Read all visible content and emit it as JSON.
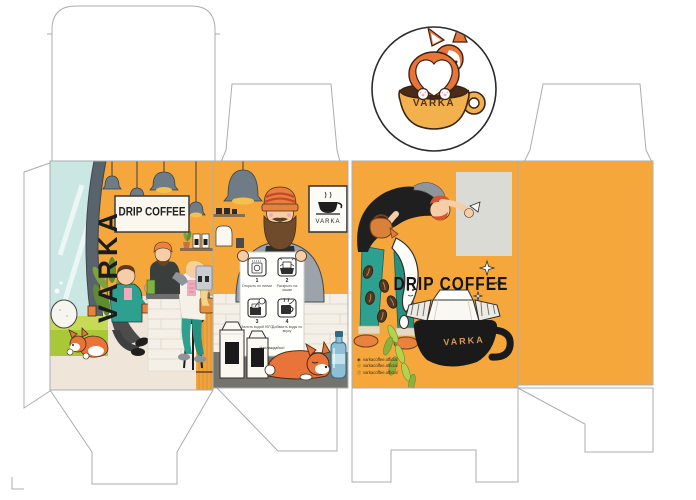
{
  "document": {
    "type": "packaging dieline",
    "description": "VARKA drip coffee box unfolded layout with illustrated panels and round sticker"
  },
  "brand": {
    "name": "VARKA"
  },
  "sticker": {
    "brand": "VARKA"
  },
  "panel_cafe": {
    "vertical_brand": "VARKA",
    "signboard": "DRIP COFFEE"
  },
  "panel_instructions": {
    "poster_brand": "VARKA",
    "sheet": {
      "steps": [
        {
          "num": "1",
          "caption": "Открыть по линии"
        },
        {
          "num": "2",
          "caption": "Раскрыть на чашке"
        },
        {
          "num": "3",
          "caption": "Залить водой 95°С"
        },
        {
          "num": "4",
          "caption": "Добавить воды по вкусу"
        }
      ],
      "footer": "Наслаждайся!"
    }
  },
  "panel_front": {
    "title": "DRIP COFFEE",
    "mug_brand": "VARKA",
    "socials": [
      {
        "icon": "instagram-icon",
        "glyph": "◉",
        "handle": "varkacoffee.official"
      },
      {
        "icon": "vk-icon",
        "glyph": "ⓥ",
        "handle": "varkacoffee.official"
      },
      {
        "icon": "facebook-icon",
        "glyph": "ⓕ",
        "handle": "varkacoffee.official"
      }
    ]
  },
  "colors": {
    "orange": "#F6A73C",
    "teal": "#2DA08F",
    "green_bench": "#A9C838",
    "leaf_green": "#8FB03A",
    "corgi_orange": "#E97439",
    "cup_yellow": "#F3B14E",
    "black": "#1F1F1F",
    "dieline_gray": "#A9ADB2",
    "window_blue": "#CBE7E3",
    "floor_beige": "#EFE5D9",
    "counter_gray": "#75736D",
    "lamp_gray": "#6F7C86"
  }
}
